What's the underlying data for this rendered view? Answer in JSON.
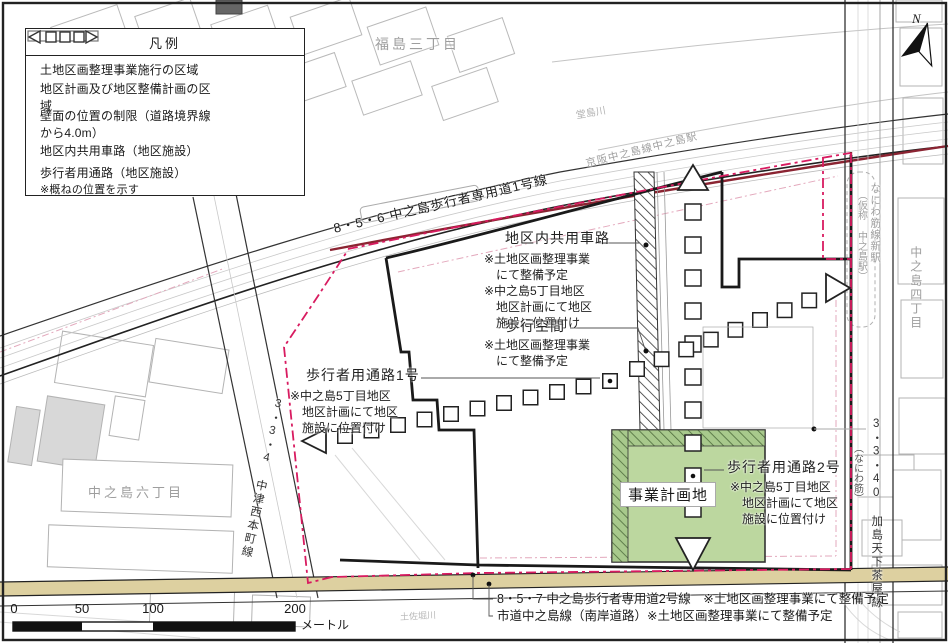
{
  "legend": {
    "title": "凡例",
    "items": [
      {
        "label": "土地区画整理事業施行の区域",
        "symbol": "thick-black-line"
      },
      {
        "label": "地区計画及び地区整備計画の区域",
        "symbol": "red-dashdot-line"
      },
      {
        "label": "壁面の位置の制限（道路境界線から4.0m）",
        "symbol": "pink-thin-dash-line"
      },
      {
        "label": "地区内共用車路（地区施設）",
        "symbol": "open-rectangle"
      },
      {
        "label": "歩行者用通路（地区施設）",
        "note": "※概ねの位置を示す",
        "symbol": "arrow-squares"
      }
    ]
  },
  "area_labels": {
    "fukushima_3": "福島三丁目",
    "dojima_river": "堂島川",
    "nakanoshima_6": "中之島六丁目",
    "nakanoshima_4": "中之島四丁目",
    "tosabori_river": "土佐堀川"
  },
  "roads": {
    "top_ped": "8・5・6 中之島歩行者専用道1号線",
    "keihan_station": "京阪中之島線中之島駅",
    "west_route": "3・3・4 中津西本町線",
    "east_route": "3・3・40 加島天下茶屋線",
    "east_alias": "（なにわ筋）",
    "naniwasuji_station_l1": "なにわ筋線新駅",
    "naniwasuji_station_l2": "（仮称 中之島駅）",
    "bottom_ped": "8・5・7 中之島歩行者専用道2号線　※土地区画整理事業にて整備予定",
    "bottom_city": "市道中之島線（南岸道路）※土地区画整理事業にて整備予定"
  },
  "callouts": {
    "shared_road": {
      "title": "地区内共用車路",
      "lines": [
        "※土地区画整理事業",
        "　にて整備予定",
        "※中之島5丁目地区",
        "　地区計画にて地区",
        "　施設に位置付け"
      ]
    },
    "walk_space": {
      "title": "歩行空間",
      "lines": [
        "※土地区画整理事業",
        "　にて整備予定"
      ]
    },
    "path1": {
      "title": "歩行者用通路1号",
      "lines": [
        "※中之島5丁目地区",
        "　地区計画にて地区",
        "　施設に位置付け"
      ]
    },
    "path2": {
      "title": "歩行者用通路2号",
      "lines": [
        "※中之島5丁目地区",
        "　地区計画にて地区",
        "　施設に位置付け"
      ]
    },
    "site": {
      "label": "事業計画地"
    }
  },
  "scale_bar": {
    "ticks": [
      "0",
      "50",
      "100",
      "200"
    ],
    "unit": "メートル"
  },
  "compass": {
    "label": "N"
  },
  "colors": {
    "boundary_black": "#1a1a1a",
    "district_red": "#d81b60",
    "rail_maroon": "#8b2432",
    "site_green": "#bcd79f",
    "road_tan": "#ddd0a0",
    "wall_limit_pink": "#e3a8bc"
  }
}
